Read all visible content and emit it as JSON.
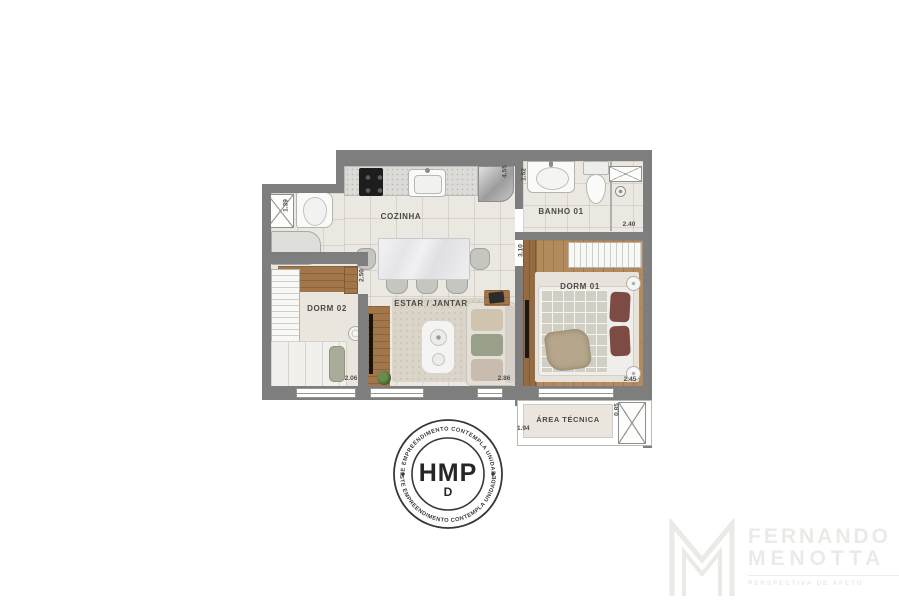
{
  "plan": {
    "room_labels": {
      "cozinha": "COZINHA",
      "banho01": "BANHO 01",
      "dorm02": "DORM 02",
      "dorm01": "DORM 01",
      "estar_jantar": "ESTAR / JANTAR",
      "area_tecnica": "ÁREA TÉCNICA"
    },
    "dimensions": {
      "laundry_depth": "1.39",
      "hall_wall_height": "4.55",
      "bath_sink_depth": "1.52",
      "bath_width": "2.40",
      "dorm02_depth": "2.50",
      "dorm01_depth": "3.10",
      "dorm02_width": "2.06",
      "estar_width": "2.86",
      "dorm01_width": "2.45",
      "area_tecnica_depth": "0.85",
      "area_tecnica_width": "1.94"
    },
    "colors": {
      "wall": "#7e7e7e",
      "floor_tile": "#ebe7e1",
      "wood": "#a0764a",
      "pillow_accent": "#7c4b43"
    }
  },
  "stamp": {
    "title": "HMP",
    "logo_glyph": "D",
    "arc_text_top": "ESTE EMPREENDIMENTO CONTEMPLA UNIDADES",
    "arc_text_bottom": "ESTE EMPREENDIMENTO CONTEMPLA UNIDADES",
    "color": "#3a3a3a"
  },
  "brand": {
    "name_line1": "FERNANDO",
    "name_line2": "MENOTTA",
    "tagline": "PERSPECTIVA DE AFETO",
    "color": "#eceae7"
  }
}
